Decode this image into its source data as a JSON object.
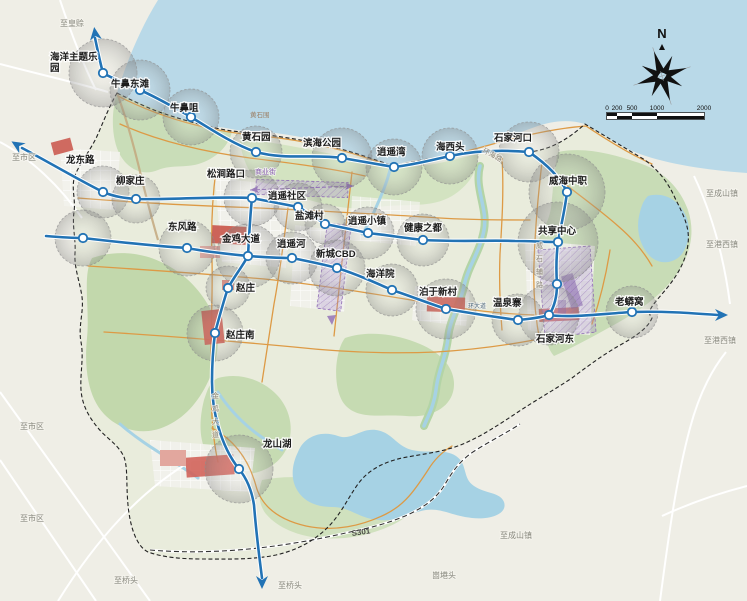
{
  "map_meta": {
    "compass_label": "N",
    "scalebar": {
      "x": 607,
      "y": 113,
      "ticks": [
        {
          "label": "0",
          "dx": 0
        },
        {
          "label": "200",
          "dx": 10
        },
        {
          "label": "500",
          "dx": 25
        },
        {
          "label": "1000",
          "dx": 50
        },
        {
          "label": "2000",
          "dx": 97
        }
      ]
    }
  },
  "colors": {
    "sea": "#b9d9e8",
    "land_outside": "#efeee6",
    "land_inside": "#e9ecdc",
    "green": "#c8dcb5",
    "water": "#a6d2e4",
    "road_orange": "#dd9a45",
    "transit_blue": "#2273b5",
    "zone_red": "#c9554a",
    "zone_purple": "#8f6cb5",
    "boundary": "#222222"
  },
  "stations": [
    {
      "name": "海洋主题乐园",
      "x": 103,
      "y": 73,
      "r": 34,
      "lx": 50,
      "ly": 60,
      "wrap": 5
    },
    {
      "name": "牛鼻东滩",
      "x": 140,
      "y": 90,
      "r": 30,
      "lx": 111,
      "ly": 87
    },
    {
      "name": "牛鼻咀",
      "x": 191,
      "y": 117,
      "r": 28,
      "lx": 170,
      "ly": 111
    },
    {
      "name": "黄石园",
      "x": 256,
      "y": 152,
      "r": 26,
      "lx": 242,
      "ly": 140
    },
    {
      "name": "滨海公园",
      "x": 342,
      "y": 158,
      "r": 30,
      "lx": 303,
      "ly": 146
    },
    {
      "name": "逍遥湾",
      "x": 394,
      "y": 167,
      "r": 28,
      "lx": 377,
      "ly": 155
    },
    {
      "name": "海西头",
      "x": 450,
      "y": 156,
      "r": 28,
      "lx": 436,
      "ly": 150
    },
    {
      "name": "石家河口",
      "x": 529,
      "y": 152,
      "r": 30,
      "lx": 494,
      "ly": 141
    },
    {
      "name": "威海中职",
      "x": 567,
      "y": 192,
      "r": 38,
      "lx": 549,
      "ly": 184
    },
    {
      "name": "共享中心",
      "x": 558,
      "y": 242,
      "r": 40,
      "lx": 538,
      "ly": 234
    },
    {
      "name": "",
      "x": 557,
      "y": 284,
      "r": 0
    },
    {
      "name": "石家河东",
      "x": 549,
      "y": 315,
      "r": 30,
      "lx": 536,
      "ly": 342
    },
    {
      "name": "老蟒窝",
      "x": 632,
      "y": 312,
      "r": 26,
      "lx": 615,
      "ly": 305
    },
    {
      "name": "龙东路",
      "x": 103,
      "y": 192,
      "r": 26,
      "lx": 66,
      "ly": 163
    },
    {
      "name": "柳家庄",
      "x": 136,
      "y": 199,
      "r": 24,
      "lx": 116,
      "ly": 184
    },
    {
      "name": "松涧路口",
      "x": 252,
      "y": 198,
      "r": 28,
      "lx": 207,
      "ly": 177
    },
    {
      "name": "逍遥社区",
      "x": 298,
      "y": 207,
      "r": 24,
      "lx": 268,
      "ly": 199
    },
    {
      "name": "盐滩村",
      "x": 325,
      "y": 224,
      "r": 20,
      "lx": 295,
      "ly": 219
    },
    {
      "name": "逍遥小镇",
      "x": 368,
      "y": 233,
      "r": 26,
      "lx": 348,
      "ly": 224
    },
    {
      "name": "健康之都",
      "x": 423,
      "y": 240,
      "r": 26,
      "lx": 404,
      "ly": 231
    },
    {
      "name": "",
      "x": 83,
      "y": 238,
      "r": 28
    },
    {
      "name": "东风路",
      "x": 187,
      "y": 248,
      "r": 28,
      "lx": 168,
      "ly": 230
    },
    {
      "name": "金鸡大道",
      "x": 248,
      "y": 256,
      "r": 32,
      "lx": 222,
      "ly": 242
    },
    {
      "name": "逍遥河",
      "x": 292,
      "y": 258,
      "r": 26,
      "lx": 277,
      "ly": 247
    },
    {
      "name": "新城CBD",
      "x": 337,
      "y": 268,
      "r": 28,
      "lx": 316,
      "ly": 257
    },
    {
      "name": "海洋院",
      "x": 392,
      "y": 290,
      "r": 26,
      "lx": 366,
      "ly": 277
    },
    {
      "name": "泊于新村",
      "x": 446,
      "y": 309,
      "r": 30,
      "lx": 419,
      "ly": 295
    },
    {
      "name": "温泉寨",
      "x": 518,
      "y": 320,
      "r": 26,
      "lx": 493,
      "ly": 306
    },
    {
      "name": "赵庄",
      "x": 228,
      "y": 288,
      "r": 22,
      "lx": 236,
      "ly": 291
    },
    {
      "name": "赵庄南",
      "x": 215,
      "y": 333,
      "r": 28,
      "lx": 226,
      "ly": 338
    },
    {
      "name": "龙山湖",
      "x": 239,
      "y": 469,
      "r": 34,
      "lx": 263,
      "ly": 447
    }
  ],
  "direction_labels": [
    {
      "text": "至皇赊",
      "x": 60,
      "y": 26
    },
    {
      "text": "至市区",
      "x": 12,
      "y": 160
    },
    {
      "text": "至市区",
      "x": 20,
      "y": 429
    },
    {
      "text": "至市区",
      "x": 20,
      "y": 521
    },
    {
      "text": "至桥头",
      "x": 114,
      "y": 583
    },
    {
      "text": "至桥头",
      "x": 278,
      "y": 588
    },
    {
      "text": "崮塂头",
      "x": 432,
      "y": 578
    },
    {
      "text": "至成山镇",
      "x": 500,
      "y": 538
    },
    {
      "text": "至成山镇",
      "x": 706,
      "y": 196
    },
    {
      "text": "至港西镇",
      "x": 706,
      "y": 247
    },
    {
      "text": "至港西镇",
      "x": 704,
      "y": 343
    }
  ],
  "road_labels": [
    {
      "text": "黄石围",
      "x": 250,
      "y": 117,
      "cls": "tiny-brown"
    },
    {
      "text": "环海路",
      "x": 482,
      "y": 152,
      "cls": "road-label",
      "rot": 28
    },
    {
      "text": "威石辅路",
      "x": 536,
      "y": 248,
      "cls": "road-label",
      "vertical": true
    },
    {
      "text": "金鸡大道",
      "x": 212,
      "y": 398,
      "cls": "road-label",
      "vertical": true
    },
    {
      "text": "环大道",
      "x": 468,
      "y": 308,
      "cls": "tiny-blue"
    },
    {
      "text": "S301",
      "x": 352,
      "y": 536,
      "cls": "s301",
      "rot": -8
    },
    {
      "text": "商业街",
      "x": 255,
      "y": 174,
      "cls": "purple"
    }
  ]
}
